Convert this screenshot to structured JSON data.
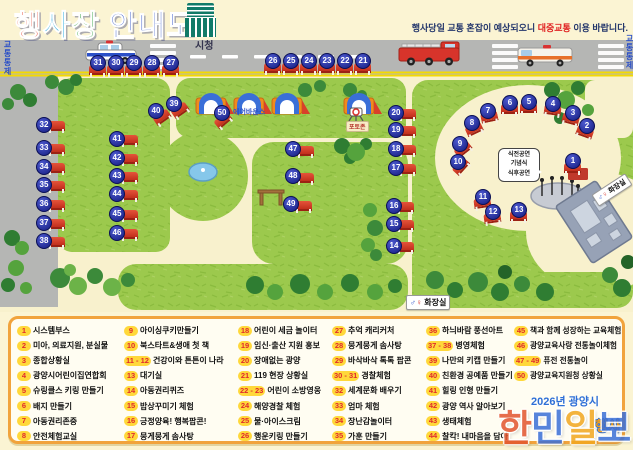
{
  "header": {
    "title_chars": [
      {
        "ch": "행",
        "color": "#e8432c"
      },
      {
        "ch": "사",
        "color": "#1fa7dd"
      },
      {
        "ch": "장",
        "color": "#2fa03c"
      },
      {
        "ch": " ",
        "color": "#000000"
      },
      {
        "ch": "안",
        "color": "#2b50c8"
      },
      {
        "ch": "내",
        "color": "#2b50c8"
      },
      {
        "ch": "도",
        "color": "#2b50c8"
      }
    ],
    "building_icon": "city-hall-icon",
    "notice": {
      "prefix": "행사당일 교통 혼잡이 예상되오니 ",
      "highlight": "대중교통",
      "suffix": " 이용 바랍니다."
    }
  },
  "map": {
    "city_hall_label": "시청",
    "traffic_control_left": "교통통제",
    "traffic_control_right": "교통통제",
    "air_bounce_label": "에어바운스",
    "photo_zone_label": "포토존",
    "stage_bubble_lines": [
      "식전공연",
      "기념식",
      "식후공연"
    ],
    "restroom_label_top": "화장실",
    "restroom_label_bottom": "화장실",
    "male_symbol": "♂",
    "female_symbol": "♀",
    "marker_color": "#141b7e",
    "tent_color": "#c22f1d",
    "markers": [
      {
        "n": "1",
        "x": 572,
        "y": 160,
        "dx": 0,
        "dy": 9,
        "rot": 0
      },
      {
        "n": "2",
        "x": 586,
        "y": 125,
        "dx": -2,
        "dy": 8,
        "rot": 20
      },
      {
        "n": "3",
        "x": 572,
        "y": 112,
        "dx": -2,
        "dy": 8,
        "rot": 15
      },
      {
        "n": "4",
        "x": 552,
        "y": 103,
        "dx": 0,
        "dy": 8,
        "rot": 8
      },
      {
        "n": "5",
        "x": 528,
        "y": 101,
        "dx": 0,
        "dy": 8,
        "rot": 0
      },
      {
        "n": "6",
        "x": 509,
        "y": 102,
        "dx": 0,
        "dy": 8,
        "rot": 0
      },
      {
        "n": "7",
        "x": 487,
        "y": 110,
        "dx": 2,
        "dy": 8,
        "rot": -12
      },
      {
        "n": "8",
        "x": 471,
        "y": 122,
        "dx": 3,
        "dy": 8,
        "rot": -25
      },
      {
        "n": "9",
        "x": 459,
        "y": 143,
        "dx": 4,
        "dy": 7,
        "rot": -38
      },
      {
        "n": "10",
        "x": 457,
        "y": 161,
        "dx": 4,
        "dy": 6,
        "rot": -48
      },
      {
        "n": "11",
        "x": 482,
        "y": 196,
        "dx": 0,
        "dy": 8,
        "rot": -8
      },
      {
        "n": "12",
        "x": 492,
        "y": 211,
        "dx": 0,
        "dy": 8,
        "rot": -8
      },
      {
        "n": "13",
        "x": 518,
        "y": 209,
        "dx": 0,
        "dy": 8,
        "rot": 0
      },
      {
        "n": "14",
        "x": 393,
        "y": 245,
        "dx": 12,
        "dy": 3,
        "rot": 0
      },
      {
        "n": "15",
        "x": 393,
        "y": 223,
        "dx": 12,
        "dy": 3,
        "rot": 0
      },
      {
        "n": "16",
        "x": 393,
        "y": 205,
        "dx": 12,
        "dy": 3,
        "rot": 0
      },
      {
        "n": "17",
        "x": 395,
        "y": 167,
        "dx": 12,
        "dy": 3,
        "rot": 0
      },
      {
        "n": "18",
        "x": 395,
        "y": 148,
        "dx": 12,
        "dy": 3,
        "rot": 0
      },
      {
        "n": "19",
        "x": 395,
        "y": 129,
        "dx": 12,
        "dy": 3,
        "rot": 0
      },
      {
        "n": "20",
        "x": 395,
        "y": 112,
        "dx": 12,
        "dy": 3,
        "rot": 0
      },
      {
        "n": "21",
        "x": 362,
        "y": 60,
        "dx": 0,
        "dy": 9,
        "rot": 0
      },
      {
        "n": "22",
        "x": 344,
        "y": 60,
        "dx": 0,
        "dy": 9,
        "rot": 0
      },
      {
        "n": "23",
        "x": 326,
        "y": 60,
        "dx": 0,
        "dy": 9,
        "rot": 0
      },
      {
        "n": "24",
        "x": 308,
        "y": 60,
        "dx": 0,
        "dy": 9,
        "rot": 0
      },
      {
        "n": "25",
        "x": 290,
        "y": 60,
        "dx": 0,
        "dy": 9,
        "rot": 0
      },
      {
        "n": "26",
        "x": 272,
        "y": 60,
        "dx": 0,
        "dy": 9,
        "rot": 0
      },
      {
        "n": "27",
        "x": 170,
        "y": 62,
        "dx": 0,
        "dy": 9,
        "rot": 0
      },
      {
        "n": "28",
        "x": 151,
        "y": 62,
        "dx": 0,
        "dy": 9,
        "rot": 0
      },
      {
        "n": "29",
        "x": 133,
        "y": 62,
        "dx": 0,
        "dy": 9,
        "rot": 0
      },
      {
        "n": "30",
        "x": 115,
        "y": 62,
        "dx": 0,
        "dy": 9,
        "rot": 0
      },
      {
        "n": "31",
        "x": 97,
        "y": 62,
        "dx": 0,
        "dy": 9,
        "rot": 0
      },
      {
        "n": "32",
        "x": 43,
        "y": 124,
        "dx": 13,
        "dy": 3,
        "rot": 0
      },
      {
        "n": "33",
        "x": 43,
        "y": 147,
        "dx": 13,
        "dy": 3,
        "rot": 0
      },
      {
        "n": "34",
        "x": 43,
        "y": 166,
        "dx": 13,
        "dy": 3,
        "rot": 0
      },
      {
        "n": "35",
        "x": 43,
        "y": 184,
        "dx": 13,
        "dy": 3,
        "rot": 0
      },
      {
        "n": "36",
        "x": 43,
        "y": 203,
        "dx": 13,
        "dy": 3,
        "rot": 0
      },
      {
        "n": "37",
        "x": 43,
        "y": 222,
        "dx": 13,
        "dy": 3,
        "rot": 0
      },
      {
        "n": "38",
        "x": 43,
        "y": 240,
        "dx": 13,
        "dy": 3,
        "rot": 0
      },
      {
        "n": "39",
        "x": 173,
        "y": 103,
        "dx": 7,
        "dy": 8,
        "rot": -35
      },
      {
        "n": "40",
        "x": 155,
        "y": 110,
        "dx": 7,
        "dy": 8,
        "rot": -35
      },
      {
        "n": "41",
        "x": 116,
        "y": 138,
        "dx": 13,
        "dy": 3,
        "rot": 0
      },
      {
        "n": "42",
        "x": 116,
        "y": 157,
        "dx": 13,
        "dy": 3,
        "rot": 0
      },
      {
        "n": "43",
        "x": 116,
        "y": 175,
        "dx": 13,
        "dy": 3,
        "rot": 0
      },
      {
        "n": "44",
        "x": 116,
        "y": 193,
        "dx": 13,
        "dy": 3,
        "rot": 0
      },
      {
        "n": "45",
        "x": 116,
        "y": 213,
        "dx": 13,
        "dy": 3,
        "rot": 0
      },
      {
        "n": "46",
        "x": 116,
        "y": 232,
        "dx": 13,
        "dy": 3,
        "rot": 0
      },
      {
        "n": "47",
        "x": 292,
        "y": 148,
        "dx": 13,
        "dy": 4,
        "rot": 0
      },
      {
        "n": "48",
        "x": 292,
        "y": 175,
        "dx": 13,
        "dy": 4,
        "rot": 0
      },
      {
        "n": "49",
        "x": 290,
        "y": 203,
        "dx": 13,
        "dy": 4,
        "rot": 0
      },
      {
        "n": "50",
        "x": 221,
        "y": 112,
        "dx": 2,
        "dy": 9,
        "rot": -40
      }
    ]
  },
  "legend": {
    "number_bg": "#ffd83a",
    "number_color": "#e02a2c",
    "columns": [
      {
        "items": [
          {
            "num": "1",
            "label": "시스템부스"
          },
          {
            "num": "2",
            "label": "미아, 의료지원, 분실물"
          },
          {
            "num": "3",
            "label": "종합상황실"
          },
          {
            "num": "4",
            "label": "광양시어린이집연합회"
          },
          {
            "num": "5",
            "label": "슈링클스 키링 만들기"
          },
          {
            "num": "6",
            "label": "배지 만들기"
          },
          {
            "num": "7",
            "label": "아동권리존중"
          },
          {
            "num": "8",
            "label": "안전체험교실"
          }
        ]
      },
      {
        "items": [
          {
            "num": "9",
            "label": "아이싱쿠키만들기"
          },
          {
            "num": "10",
            "label": "북스타트&생애 첫 책"
          },
          {
            "num": "11 - 12",
            "label": "건강이와 튼튼이 나라"
          },
          {
            "num": "13",
            "label": "대기실"
          },
          {
            "num": "14",
            "label": "아동권리퀴즈"
          },
          {
            "num": "15",
            "label": "밥상꾸미기 체험"
          },
          {
            "num": "16",
            "label": "긍정양육! 행복팝콘!"
          },
          {
            "num": "17",
            "label": "뭉게뭉게 솜사탕"
          }
        ]
      },
      {
        "items": [
          {
            "num": "18",
            "label": "어린이 세금 놀이터"
          },
          {
            "num": "19",
            "label": "임신·출산 지원 홍보"
          },
          {
            "num": "20",
            "label": "장애없는 광양"
          },
          {
            "num": "21",
            "label": "119 현장 상황실"
          },
          {
            "num": "22 - 23",
            "label": "어린이 소방영웅"
          },
          {
            "num": "24",
            "label": "해양경찰 체험"
          },
          {
            "num": "25",
            "label": "물·아이스크림"
          },
          {
            "num": "26",
            "label": "행운키링 만들기"
          }
        ]
      },
      {
        "items": [
          {
            "num": "27",
            "label": "추억 캐리커처"
          },
          {
            "num": "28",
            "label": "뭉게뭉게 솜사탕"
          },
          {
            "num": "29",
            "label": "바삭바삭 톡톡 팝콘"
          },
          {
            "num": "30 - 31",
            "label": "경찰체험"
          },
          {
            "num": "32",
            "label": "세계문화 배우기"
          },
          {
            "num": "33",
            "label": "엄마 체험"
          },
          {
            "num": "34",
            "label": "장난감놀이터"
          },
          {
            "num": "35",
            "label": "가훈 만들기"
          }
        ]
      },
      {
        "items": [
          {
            "num": "36",
            "label": "하늬바람 풍선아트"
          },
          {
            "num": "37 - 38",
            "label": "병영체험"
          },
          {
            "num": "39",
            "label": "나만의 키캡 만들기"
          },
          {
            "num": "40",
            "label": "친환경 공예품 만들기"
          },
          {
            "num": "41",
            "label": "힐링 인형 만들기"
          },
          {
            "num": "42",
            "label": "광양 역사 알아보기"
          },
          {
            "num": "43",
            "label": "생태체험"
          },
          {
            "num": "44",
            "label": "찰칵! 내마음을 담아"
          }
        ]
      },
      {
        "items": [
          {
            "num": "45",
            "label": "책과 함께 성장하는 교육체험"
          },
          {
            "num": "46",
            "label": "광양교육사랑 전통놀이체험"
          },
          {
            "num": "47 - 49",
            "label": "퓨전 전통놀이"
          },
          {
            "num": "50",
            "label": "광양교육지원청 상황실"
          }
        ]
      }
    ]
  },
  "footer": {
    "organizer": "2026년 광양시",
    "partial_event_text": "행사",
    "watermark_chars": [
      {
        "ch": "한",
        "color": "#e2552e"
      },
      {
        "ch": "민",
        "color": "#3a6fd8"
      },
      {
        "ch": "일",
        "color": "#f2a71f"
      },
      {
        "ch": "보",
        "color": "#3a6fd8"
      }
    ]
  }
}
